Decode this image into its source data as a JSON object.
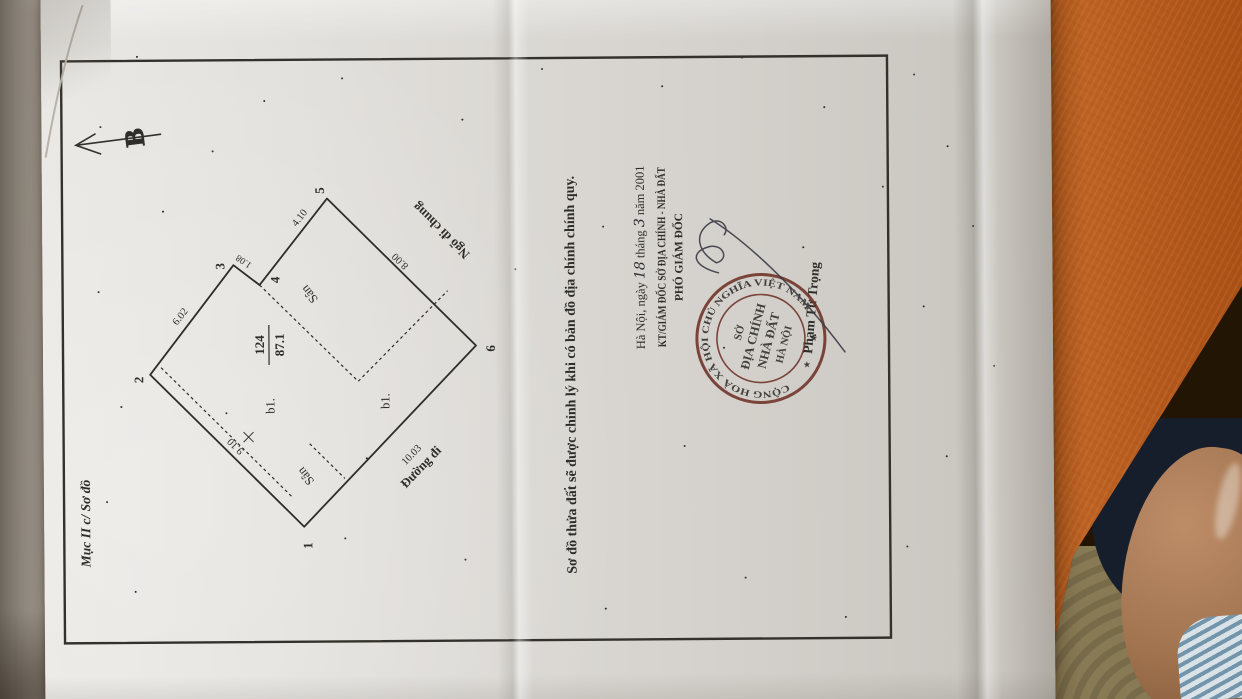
{
  "colors": {
    "table_wood": "#b2571c",
    "paper": "#e2e0dc",
    "ink": "#2f2d29",
    "stamp_red": "#6e3126",
    "floor_khaki": "#887a54",
    "skin": "#a1734f",
    "clothing_navy": "#171e2b",
    "sock_stripe": "#7395ab"
  },
  "document": {
    "section_label": "Mục II c/ Sơ đồ",
    "north_label": "B",
    "caption": "Sơ đồ thửa đất sẽ được chỉnh lý khi có bản đồ địa chính chính quy.",
    "diagram": {
      "parcel_number": "124",
      "area": "87.1",
      "vertex_1": "1",
      "vertex_2": "2",
      "vertex_3": "3",
      "vertex_4": "4",
      "vertex_5": "5",
      "vertex_6": "6",
      "dim_1_2": "9.10",
      "dim_2_3": "6.02",
      "dim_3_4": "1.08",
      "dim_4_5": "4.10",
      "dim_5_6": "8.00",
      "dim_6_1": "10.03",
      "yard_label": "Sân",
      "building_label": "b1.",
      "alley_label": "Ngõ đi chung",
      "road_label": "Đường đi"
    },
    "signature_block": {
      "place_date_prefix": "Hà Nội, ngày",
      "day": "18",
      "month_word": "tháng",
      "month": "3",
      "year_suffix": "năm 2001",
      "approver_title": "KT/GIÁM ĐỐC SỞ ĐỊA CHÍNH - NHÀ ĐẤT",
      "approver_subtitle": "PHÓ GIÁM ĐỐC",
      "signer_name": "Phạm Tử Trọng"
    },
    "stamp": {
      "ring_text": "CỘNG HOÀ XÃ HỘI CHỦ NGHĨA VIỆT NAM",
      "star": "★",
      "line1": "SỞ",
      "line2": "ĐỊA CHÍNH",
      "line3": "NHÀ ĐẤT",
      "line4": "HÀ NỘI"
    }
  }
}
